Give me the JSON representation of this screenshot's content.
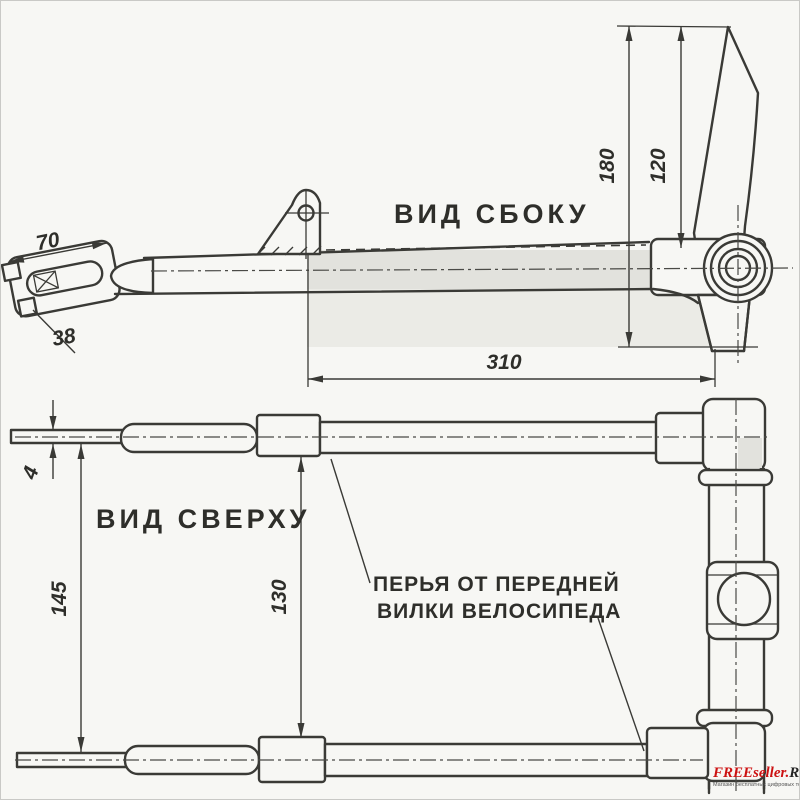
{
  "labels": {
    "side_view": "ВИД СБОКУ",
    "top_view": "ВИД СВЕРХУ",
    "annotation_line1": "ПЕРЬЯ ОТ ПЕРЕДНЕЙ",
    "annotation_line2": "ВИЛКИ ВЕЛОСИПЕДА"
  },
  "dimensions": {
    "clevis_length": "70",
    "clevis_width": "38",
    "beam_length": "310",
    "blade_height_outer": "180",
    "blade_height_inner": "120",
    "rod_thickness": "4",
    "outer_span": "145",
    "inner_span": "130"
  },
  "watermark": {
    "brand_red": "FREEseller.",
    "brand_dark": "RU",
    "tagline": "Магазин бесплатных цифровых товаров"
  },
  "colors": {
    "ink": "#3a3a36",
    "background": "#f7f7f4",
    "shade": "#e2e2dd",
    "shade_light": "#ebebe6",
    "brand_red": "#cc1111",
    "brand_dark": "#222222"
  }
}
